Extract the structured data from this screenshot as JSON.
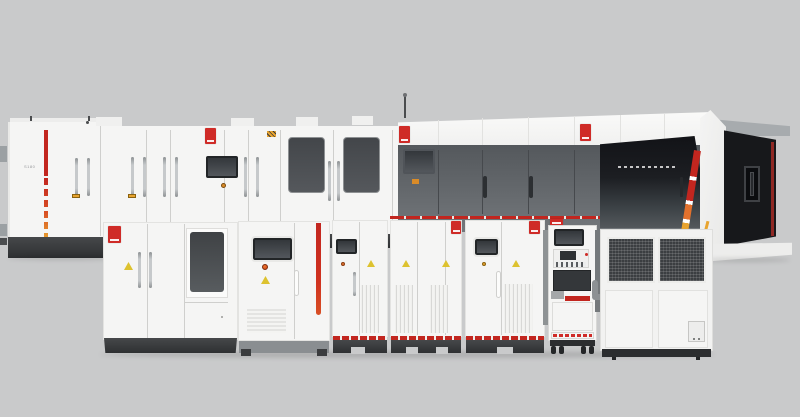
{
  "scene": {
    "description": "Product render: lineup of white industrial test equipment — rear cabinet row with window doors, large laser test machine with dark glass enclosure, five front power cabinets, a narrow instrument rack and a chiller unit, on a plain gray studio background"
  },
  "colors": {
    "scene-bg": "#c9cacb",
    "panel-white": "#f5f5f4",
    "gap-line": "#cfcfcd",
    "base-gray": "#8a8e91",
    "machine-gray": "#5c6064",
    "glass-dark": "#1b1d21",
    "screen-dark": "#3a3e42",
    "brand-red": "#cf2b27",
    "stripe-red": "#c2261f",
    "accent-orange": "#e2712d",
    "accent-amber": "#e8a430",
    "warning-yellow": "#ddc22f"
  },
  "labels": {
    "left_cabinet_model": "S180"
  }
}
